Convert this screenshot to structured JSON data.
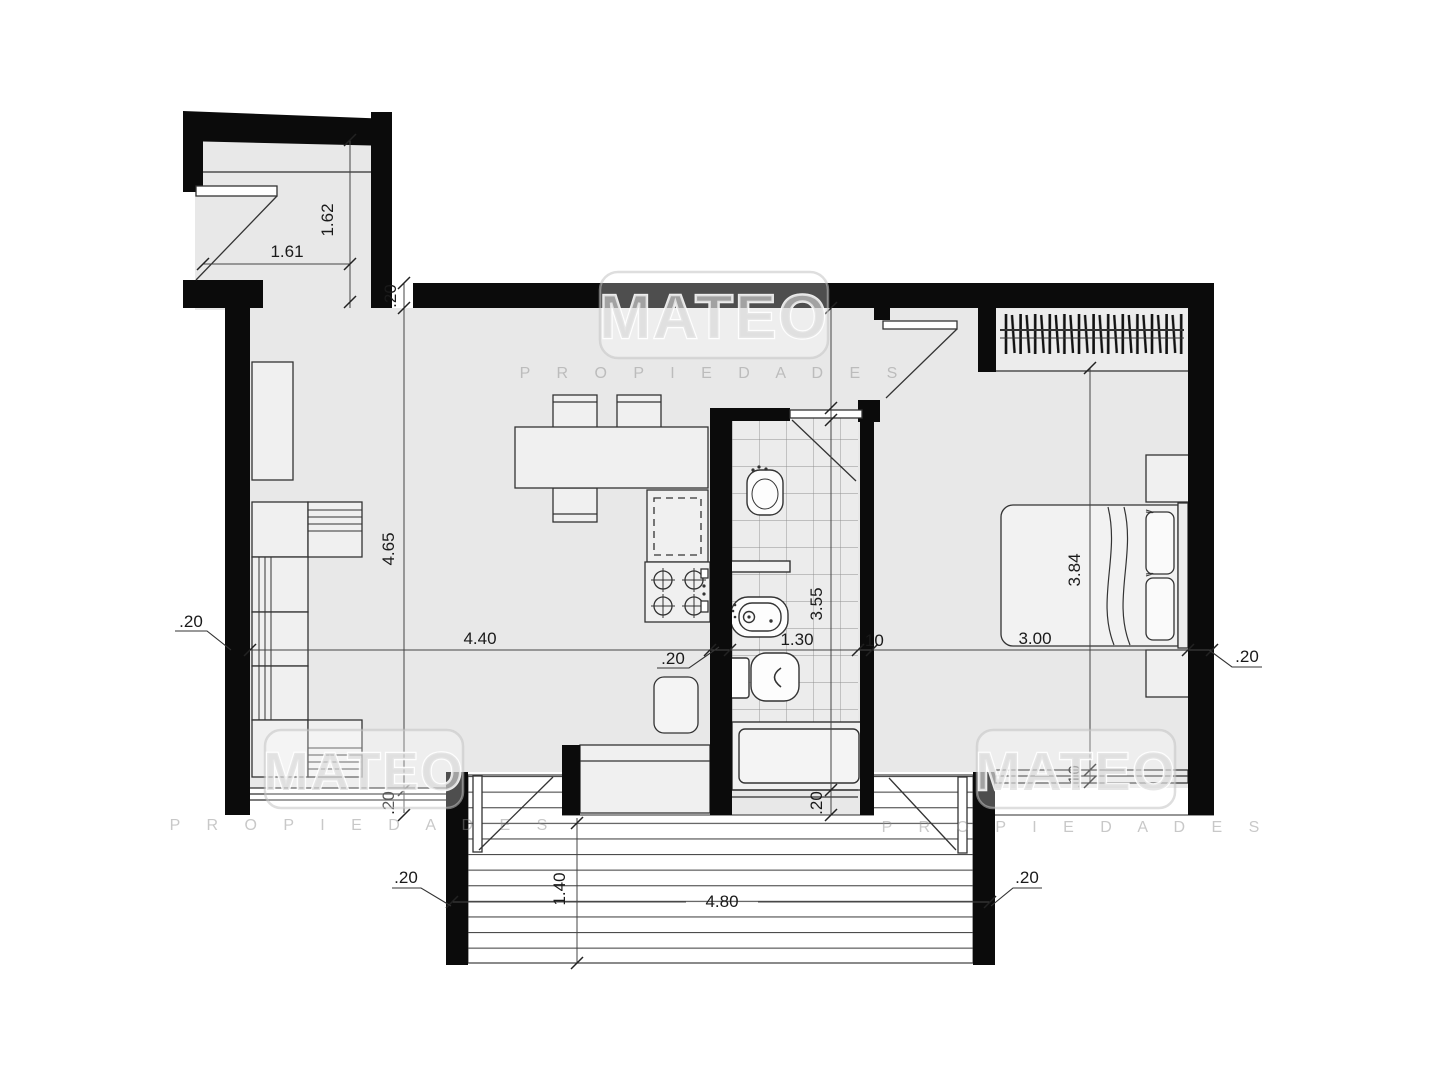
{
  "watermark": {
    "brand": "MATEO",
    "subtitle": "P R O P I E D A D E S"
  },
  "dimensions": {
    "entry_width": "1.61",
    "entry_depth": "1.62",
    "top_wall_thickness": ".20",
    "hall_opening": "1.00",
    "living_depth": "4.65",
    "living_width": "4.40",
    "left_wall_thickness": ".20",
    "kitchen_wall_thickness": ".20",
    "bath_width": "1.30",
    "bath_depth": "3.55",
    "partition_thickness": ".10",
    "bedroom_width": "3.00",
    "bedroom_depth": "3.84",
    "right_wall_thickness": ".20",
    "bedroom_window_thickness": ".10",
    "bath_bottom_wall": ".20",
    "living_bottom_wall": ".20",
    "deck_left_wall": ".20",
    "deck_right_wall": ".20",
    "deck_depth": "1.40",
    "deck_width": "4.80"
  },
  "colors": {
    "wall": "#0b0b0b",
    "floor": "#e8e8e8",
    "dimension_line": "#444444",
    "fixture_stroke": "#333333",
    "watermark": "#d6d6d6"
  }
}
